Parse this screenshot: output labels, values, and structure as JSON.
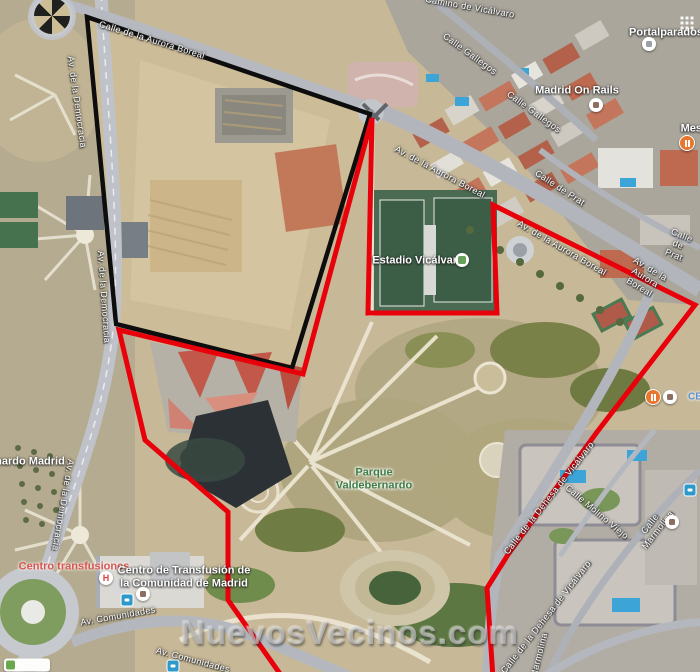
{
  "watermark": "NuevosVecinos.com",
  "overlays": [
    {
      "name": "black-boundary",
      "color": "#0d0d0d",
      "width": 4.5,
      "points": [
        [
          87,
          17
        ],
        [
          370,
          114
        ],
        [
          292,
          368
        ],
        [
          116,
          324
        ]
      ]
    },
    {
      "name": "red-boundary",
      "color": "#e8000b",
      "width": 5,
      "points": [
        [
          372,
          118
        ],
        [
          368,
          313
        ],
        [
          497,
          313
        ],
        [
          493,
          205
        ],
        [
          695,
          305
        ],
        [
          597,
          432
        ],
        [
          509,
          553
        ],
        [
          487,
          588
        ],
        [
          493,
          678
        ],
        [
          283,
          678
        ],
        [
          228,
          600
        ],
        [
          228,
          512
        ],
        [
          145,
          440
        ],
        [
          119,
          330
        ],
        [
          303,
          374
        ]
      ]
    }
  ],
  "map_labels": [
    {
      "text": "Calle de la Aurora Boreal",
      "x": 152,
      "y": 40,
      "rot": 17,
      "type": "street",
      "name": "street-label-calle-aurora-boreal",
      "interactable": false
    },
    {
      "text": "Av. de la Democracia",
      "x": 77,
      "y": 102,
      "rot": 82,
      "type": "street",
      "name": "street-label-av-democracia-1",
      "interactable": false
    },
    {
      "text": "Av. de la Democracia",
      "x": 104,
      "y": 297,
      "rot": 86,
      "type": "street",
      "name": "street-label-av-democracia-2",
      "interactable": false
    },
    {
      "text": "Av. de la Democracia",
      "x": 63,
      "y": 505,
      "rot": 100,
      "type": "street",
      "name": "street-label-av-democracia-3",
      "interactable": false
    },
    {
      "text": "Camino de Vicálvaro",
      "x": 470,
      "y": 7,
      "rot": 10,
      "type": "street",
      "name": "street-label-camino-vicalvaro",
      "interactable": false
    },
    {
      "text": "Calle Gallegos",
      "x": 470,
      "y": 54,
      "rot": 36,
      "type": "street",
      "name": "street-label-calle-gallegos-1",
      "interactable": false
    },
    {
      "text": "Calle Gallegos",
      "x": 534,
      "y": 112,
      "rot": 36,
      "type": "street",
      "name": "street-label-calle-gallegos-2",
      "interactable": false
    },
    {
      "text": "Av. de la Aurora Boreal",
      "x": 440,
      "y": 172,
      "rot": 28,
      "type": "street",
      "name": "street-label-av-aurora-boreal-1",
      "interactable": false
    },
    {
      "text": "Av. de la Aurora Boreal",
      "x": 562,
      "y": 248,
      "rot": 30,
      "type": "street",
      "name": "street-label-av-aurora-boreal-2",
      "interactable": false
    },
    {
      "text": "Av. de la Aurora Boreal",
      "x": 645,
      "y": 278,
      "rot": 31,
      "type": "street",
      "name": "street-label-av-aurora-boreal-3",
      "interactable": false
    },
    {
      "text": "Calle de Prat",
      "x": 560,
      "y": 188,
      "rot": 33,
      "type": "street",
      "name": "street-label-calle-de-prat-1",
      "interactable": false
    },
    {
      "text": "Calle de Prat",
      "x": 678,
      "y": 245,
      "rot": 22,
      "type": "street",
      "name": "street-label-calle-de-prat-2",
      "interactable": false
    },
    {
      "text": "Calle de la Dehesa de Vicálvaro",
      "x": 549,
      "y": 498,
      "rot": -52,
      "type": "street",
      "name": "street-label-dehesa-vicalvaro-1",
      "interactable": false
    },
    {
      "text": "Calle de la Dehesa de Vicálvaro",
      "x": 546,
      "y": 617,
      "rot": -52,
      "type": "street",
      "name": "street-label-dehesa-vicalvaro-2",
      "interactable": false
    },
    {
      "text": "Calle Molino Viejo",
      "x": 597,
      "y": 512,
      "rot": 40,
      "type": "street",
      "name": "street-label-calle-molino-viejo",
      "interactable": false
    },
    {
      "text": "Calle Marmolina",
      "x": 654,
      "y": 527,
      "rot": -52,
      "type": "street",
      "name": "street-label-calle-marmolina",
      "interactable": false
    },
    {
      "text": "Marmolina",
      "x": 539,
      "y": 655,
      "rot": -76,
      "type": "street",
      "name": "street-label-marmolina-partial",
      "interactable": false
    },
    {
      "text": "Av. Comunidades",
      "x": 118,
      "y": 616,
      "rot": -10,
      "type": "street",
      "name": "street-label-av-comunidades-1",
      "interactable": false
    },
    {
      "text": "Av. Comunidades",
      "x": 193,
      "y": 660,
      "rot": 15,
      "type": "street",
      "name": "street-label-av-comunidades-2",
      "interactable": false
    },
    {
      "text": "nardo Madrid",
      "x": 30,
      "y": 462,
      "rot": 0,
      "type": "place",
      "name": "place-label-partial-nardo-madrid",
      "interactable": false
    },
    {
      "text": "Portalparados",
      "x": 666,
      "y": 33,
      "rot": 0,
      "type": "place",
      "name": "place-label-portalparados",
      "interactable": true
    },
    {
      "text": "Madrid On Rails",
      "x": 577,
      "y": 91,
      "rot": 0,
      "type": "place",
      "name": "place-label-madrid-on-rails",
      "interactable": true
    },
    {
      "text": "Mesón",
      "x": 698,
      "y": 129,
      "rot": 0,
      "type": "place",
      "name": "place-label-meson-partial",
      "interactable": true
    },
    {
      "text": "Estadio Vicálvaro",
      "x": 418,
      "y": 261,
      "rot": 0,
      "type": "place",
      "name": "place-label-estadio-vicalvaro",
      "interactable": true
    },
    {
      "text": "Parque\nValdebernardo",
      "x": 374,
      "y": 479,
      "rot": 0,
      "type": "park",
      "name": "park-label-parque-valdebernardo",
      "interactable": true
    },
    {
      "text": "Centro transfusiones",
      "x": 74,
      "y": 567,
      "rot": 0,
      "type": "medical",
      "name": "medical-label-centro-transfusiones",
      "interactable": true
    },
    {
      "text": "Centro de Transfusión de\nla Comunidad de Madrid",
      "x": 184,
      "y": 577,
      "rot": 0,
      "type": "place",
      "name": "place-label-centro-transfusion",
      "interactable": true
    },
    {
      "text": "CE",
      "x": 695,
      "y": 397,
      "rot": 0,
      "type": "school",
      "name": "school-label-ce-partial",
      "interactable": true
    }
  ],
  "markers": [
    {
      "icon": "grid",
      "x": 682,
      "y": 18,
      "name": "apartments-grid-icon",
      "interactable": false
    },
    {
      "icon": "store",
      "color": "#9aa0a6",
      "x": 649,
      "y": 44,
      "name": "portalparados-marker-icon",
      "interactable": true
    },
    {
      "icon": "restaurant",
      "x": 687,
      "y": 143,
      "name": "restaurant-icon",
      "interactable": true
    },
    {
      "icon": "store",
      "color": "#8d6e63",
      "x": 596,
      "y": 105,
      "name": "madrid-on-rails-marker-icon",
      "interactable": true
    },
    {
      "icon": "stadium",
      "x": 462,
      "y": 260,
      "name": "stadium-marker-icon",
      "interactable": true
    },
    {
      "icon": "restaurant",
      "x": 653,
      "y": 397,
      "name": "restaurant-icon",
      "interactable": true
    },
    {
      "icon": "store",
      "color": "#8d6e63",
      "x": 670,
      "y": 397,
      "name": "store-icon",
      "interactable": true
    },
    {
      "icon": "store",
      "color": "#8d6e63",
      "x": 672,
      "y": 522,
      "name": "cafe-icon",
      "interactable": true
    },
    {
      "icon": "bus",
      "x": 690,
      "y": 490,
      "name": "bus-stop-icon",
      "interactable": true
    },
    {
      "icon": "hospital",
      "label": "H",
      "x": 106,
      "y": 578,
      "name": "hospital-icon",
      "interactable": true
    },
    {
      "icon": "store",
      "color": "#8d6e63",
      "x": 143,
      "y": 594,
      "name": "transfusion-marker-icon",
      "interactable": true
    },
    {
      "icon": "bus",
      "x": 127,
      "y": 600,
      "name": "bus-stop-icon",
      "interactable": true
    },
    {
      "icon": "bus",
      "x": 173,
      "y": 666,
      "name": "bus-stop-icon",
      "interactable": true
    },
    {
      "icon": "chip",
      "x": 27,
      "y": 665,
      "name": "map-chip",
      "interactable": true
    }
  ]
}
